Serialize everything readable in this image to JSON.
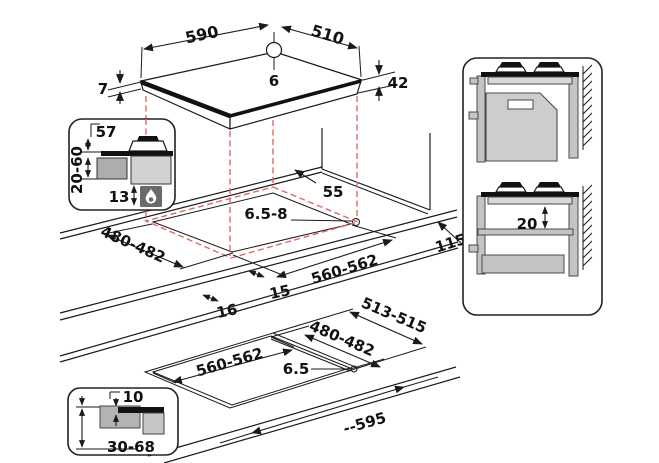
{
  "hob": {
    "width": "590",
    "depth": "510",
    "hole": "6",
    "height": "42",
    "rim": "7"
  },
  "burner_section": {
    "height_above": "57",
    "worktop_thickness": "20-60",
    "inlet": "13"
  },
  "worktop_cutout": {
    "rear_clearance": "55",
    "corner_radius": "6.5-8",
    "side_clearance": "115",
    "depth": "480-482",
    "width": "560-562",
    "front_overlap": "15",
    "side_overlap": "16"
  },
  "clearance_panel": {
    "gap_below": "20"
  },
  "flush_cutout": {
    "outer_depth": "513-515",
    "inner_depth": "480-482",
    "width": "560-562",
    "corner_radius": "6.5",
    "overall_width": "--595"
  },
  "flush_section": {
    "ledge": "10",
    "worktop_thickness": "30-68"
  },
  "colors": {
    "line": "#1a1a1a",
    "dashed_projection": "#e06868",
    "fill_gray": "#cdcdcd"
  }
}
